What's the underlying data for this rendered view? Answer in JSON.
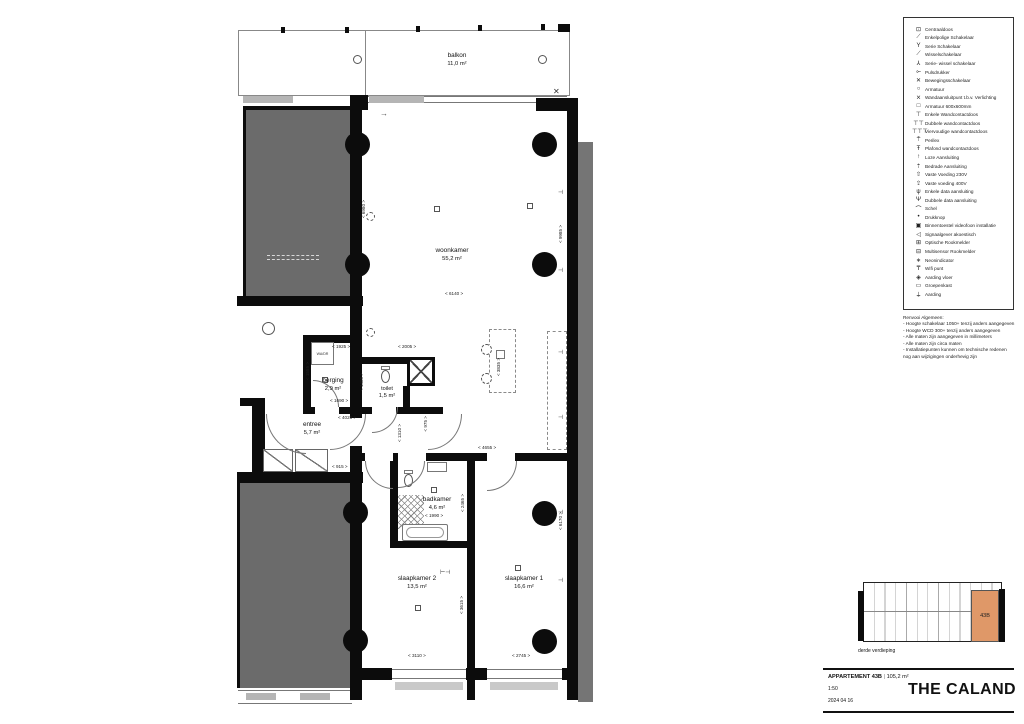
{
  "plan": {
    "rooms": {
      "balkon": {
        "name": "balkon",
        "area": "11,0 m²"
      },
      "woonkamer": {
        "name": "woonkamer",
        "area": "55,2 m²"
      },
      "berging": {
        "name": "berging",
        "area": "2,9 m²"
      },
      "toilet": {
        "name": "toilet",
        "area": "1,5 m²"
      },
      "entree": {
        "name": "entree",
        "area": "5,7 m²"
      },
      "badkamer": {
        "name": "badkamer",
        "area": "4,6 m²"
      },
      "slaapkamer2": {
        "name": "slaapkamer 2",
        "area": "13,5 m²"
      },
      "slaapkamer1": {
        "name": "slaapkamer 1",
        "area": "16,6 m²"
      }
    },
    "appliance_label": "WA/DR",
    "dims": [
      "< 6980 >",
      "< 9985 >",
      "< 6140 >",
      "< 1925 >",
      "< 2005 >",
      "< 1555 >",
      "< 1485 >",
      "< 1690 >",
      "< 4025 >",
      "< 915 >",
      "< 1310 >",
      "< 975 >",
      "< 4655 >",
      "< 3835 >",
      "< 1990 >",
      "< 2465 >",
      "< 3615 >",
      "< 3110 >",
      "< 2745 >",
      "< 6170 >"
    ]
  },
  "legend": {
    "items": [
      {
        "icon": "centraaldoos-icon",
        "label": "Centraaldoos"
      },
      {
        "icon": "single-pole-switch-icon",
        "label": "Enkelpolige Schakelaar"
      },
      {
        "icon": "series-switch-icon",
        "label": "Serie Schakelaar"
      },
      {
        "icon": "two-way-switch-icon",
        "label": "Wisselschakelaar"
      },
      {
        "icon": "series-two-way-switch-icon",
        "label": "Serie- wissel schakelaar"
      },
      {
        "icon": "push-button-icon",
        "label": "Pulsdrukker"
      },
      {
        "icon": "motion-switch-icon",
        "label": "Bewegingsschakelaar"
      },
      {
        "icon": "luminaire-icon",
        "label": "Armatuur"
      },
      {
        "icon": "wall-light-point-icon",
        "label": "Wandaansluitpunt t.b.v. Verlichting"
      },
      {
        "icon": "luminaire-600x600-icon",
        "label": "Armatuur 600x600mm"
      },
      {
        "icon": "single-socket-icon",
        "label": "Enkele Wandcontactdoos"
      },
      {
        "icon": "double-socket-icon",
        "label": "Dubbele wandcontactdoos"
      },
      {
        "icon": "quad-socket-icon",
        "label": "Viervoudige wandcontactdoos"
      },
      {
        "icon": "perilex-icon",
        "label": "Perilex"
      },
      {
        "icon": "ceiling-socket-icon",
        "label": "Plafond wandcontactdoos"
      },
      {
        "icon": "unwired-connection-icon",
        "label": "Loze Aansluiting"
      },
      {
        "icon": "wired-connection-icon",
        "label": "Bedrade Aansluiting"
      },
      {
        "icon": "fixed-supply-230v-icon",
        "label": "Vaste Voeding 230V"
      },
      {
        "icon": "fixed-supply-400v-icon",
        "label": "Vaste voeding 400V"
      },
      {
        "icon": "single-data-icon",
        "label": "Enkele data aansluiting"
      },
      {
        "icon": "double-data-icon",
        "label": "Dubbele data aansluiting"
      },
      {
        "icon": "bell-icon",
        "label": "Schel"
      },
      {
        "icon": "push-knob-icon",
        "label": "Drukknop"
      },
      {
        "icon": "video-intercom-icon",
        "label": "Binnentoestel videofoon installatie"
      },
      {
        "icon": "acoustic-signal-icon",
        "label": "Signaalgever akoestisch"
      },
      {
        "icon": "optical-smoke-detector-icon",
        "label": "Optische Rookmelder"
      },
      {
        "icon": "multisensor-smoke-detector-icon",
        "label": "Multisensor Rookmelder"
      },
      {
        "icon": "neon-indicator-icon",
        "label": "Neonindicator"
      },
      {
        "icon": "wifi-point-icon",
        "label": "Wifi punt"
      },
      {
        "icon": "floor-earth-icon",
        "label": "Aarding vloer"
      },
      {
        "icon": "distribution-board-icon",
        "label": "Groepenkast"
      },
      {
        "icon": "earth-icon",
        "label": "Aarding"
      }
    ]
  },
  "notes": {
    "title": "Renvooi Algemeen:",
    "lines": [
      "- Hoogte schakelaar 1050+ tenzij anders aangegeven",
      "- Hoogte WCD 300+ tenzij anders aangegeven",
      "- Alle maten zijn aangegeven in millimeters",
      "- Alle maten zijn circa maten",
      "- Installatiepunten kunnen om technische redenen",
      "  nog aan wijzigingen onderhevig zijn"
    ]
  },
  "titleblock": {
    "apartment": "APPARTEMENT 43B",
    "separator": "|",
    "area": "105,2 m²",
    "scale": "1:50",
    "date": "2024 04 16",
    "project": "THE CALAND",
    "floor_label": "derde verdieping",
    "unit_badge": "43B"
  },
  "colors": {
    "highlight": "#DF9868",
    "mass_gray": "#6b6b6b",
    "wall_black": "#0c0c0c"
  }
}
